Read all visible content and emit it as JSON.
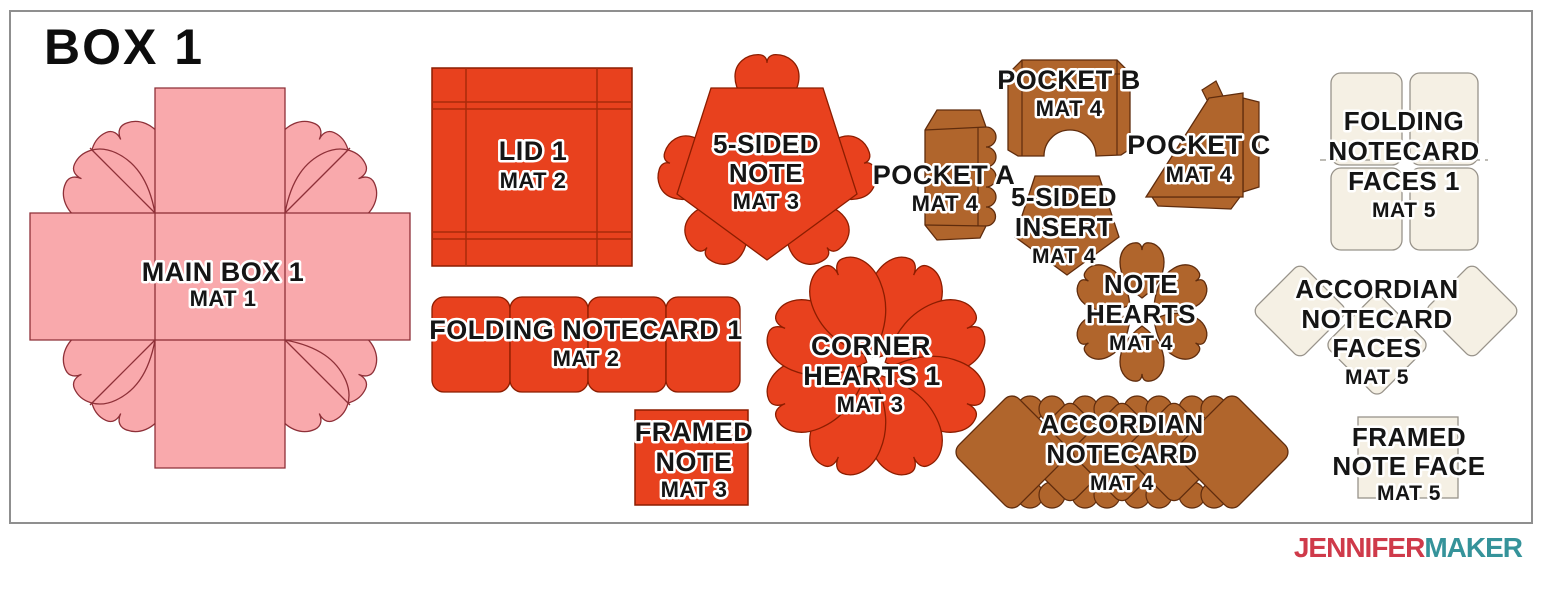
{
  "title": "BOX 1",
  "logo": {
    "jennifer": "JENNIFER",
    "maker": "MAKER"
  },
  "colors": {
    "pink": "#f9a9ac",
    "pink_stroke": "#8e3038",
    "red": "#e8411e",
    "red_stroke": "#8c1d00",
    "red_line": "#a82a0a",
    "brown": "#b0652c",
    "brown_stroke": "#5f2c0d",
    "cream": "#f5f0e4",
    "cream_stroke": "#98938a",
    "frame_gray": "#8f8f8f",
    "label_black": "#151515",
    "halo_white": "#ffffff",
    "logo_red": "#cf3a4a",
    "logo_teal": "#35939a",
    "title_black": "#0d0d0d"
  },
  "pieces": {
    "main_box": {
      "line1": "MAIN BOX 1",
      "mat": "MAT 1"
    },
    "lid": {
      "line1": "LID 1",
      "mat": "MAT 2"
    },
    "folding_notecard": {
      "line1": "FOLDING NOTECARD 1",
      "mat": "MAT 2"
    },
    "five_sided_note": {
      "line1": "5-SIDED",
      "line2": "NOTE",
      "mat": "MAT 3"
    },
    "framed_note": {
      "line1": "FRAMED",
      "line2": "NOTE",
      "mat": "MAT 3"
    },
    "corner_hearts": {
      "line1": "CORNER",
      "line2": "HEARTS 1",
      "mat": "MAT 3"
    },
    "pocket_a": {
      "line1": "POCKET A",
      "mat": "MAT 4"
    },
    "pocket_b": {
      "line1": "POCKET B",
      "mat": "MAT 4"
    },
    "pocket_c": {
      "line1": "POCKET C",
      "mat": "MAT 4"
    },
    "five_sided_insert": {
      "line1": "5-SIDED",
      "line2": "INSERT",
      "mat": "MAT 4"
    },
    "note_hearts": {
      "line1": "NOTE",
      "line2": "HEARTS",
      "mat": "MAT 4"
    },
    "accordian_notecard": {
      "line1": "ACCORDIAN",
      "line2": "NOTECARD",
      "mat": "MAT 4"
    },
    "folding_notecard_faces": {
      "line1": "FOLDING",
      "line2": "NOTECARD",
      "line3": "FACES 1",
      "mat": "MAT 5"
    },
    "accordian_notecard_faces": {
      "line1": "ACCORDIAN",
      "line2": "NOTECARD",
      "line3": "FACES",
      "mat": "MAT 5"
    },
    "framed_note_face": {
      "line1": "FRAMED",
      "line2": "NOTE FACE",
      "mat": "MAT 5"
    }
  }
}
